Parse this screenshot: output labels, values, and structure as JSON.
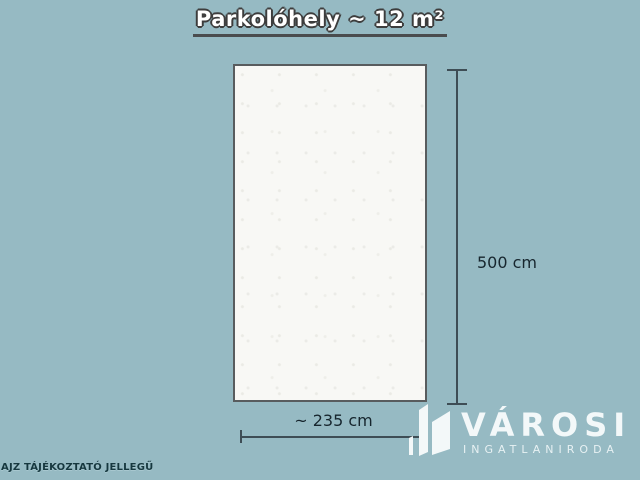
{
  "title": {
    "text": "Parkolóhely ~ 12 m²"
  },
  "plan": {
    "type": "parking-space-floor-plan",
    "area_label": "~ 12 m²"
  },
  "dimensions": {
    "height": "500 cm",
    "width": "~ 235 cm"
  },
  "brand": {
    "name": "VÁROSI",
    "subtitle": "INGATLANIRODA",
    "icon": "buildings-icon"
  },
  "disclaimer": {
    "text": "AJZ TÁJÉKOZTATÓ JELLEGŰ"
  },
  "colors": {
    "background": "#96bac3",
    "plan_fill": "#f8f8f5",
    "plan_border": "#585c5e",
    "dimension_line": "#3e4d55",
    "label_text": "#17262e",
    "title_text": "#ffffff",
    "title_outline": "#3d3d3d",
    "title_underline": "#4a4c4e",
    "logo_text": "#f3f8f9",
    "disclaimer_text": "#16383f"
  }
}
